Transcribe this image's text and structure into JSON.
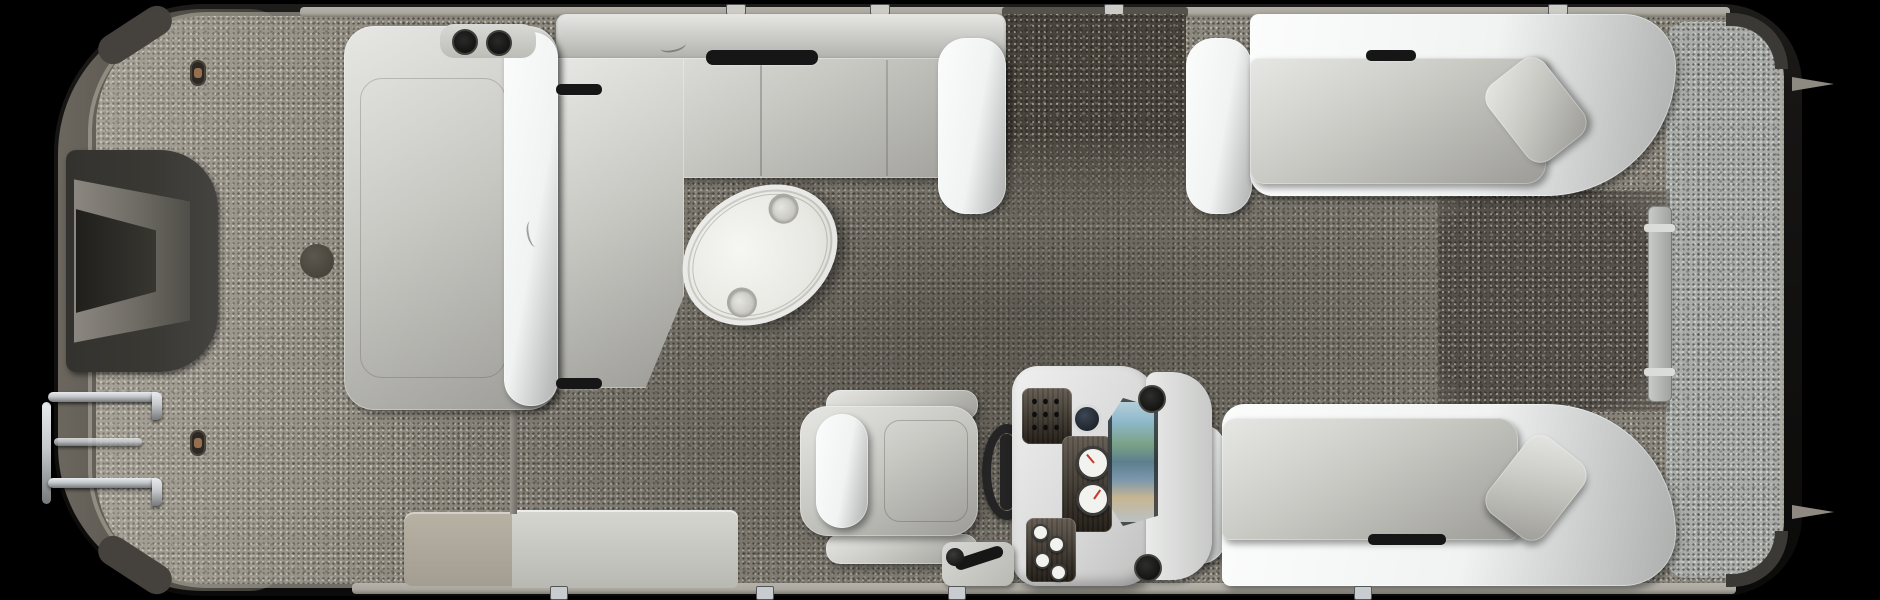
{
  "image": {
    "alt": "Overhead 3D render of a pontoon boat floor plan: bow boarding platform with ladder at left, long port chaise lounger, wraparound benches with an oval cocktail table, captain's chair with helm console and gauges, twin curved stern lounges with rear gate and swim deck at right"
  },
  "colors": {
    "background": "#000000",
    "hull_dark": "#161514",
    "bow_trim": "#6b675f",
    "notch_dark": "#3a3833",
    "rail_light": "#aaa79e",
    "carpet_main": "#8d897f",
    "carpet_dark": "#48443c",
    "carpet_rear": "#a9aca9",
    "upholstery": "#c9c9c4",
    "upholstery_bright": "#f1f3f3",
    "table_top": "#f6f6f2",
    "console_white": "#eff0ef",
    "dash_wood": "#473d30",
    "detail_black": "#161616",
    "gauge_face": "#f2f2ee",
    "needle_red": "#c23b2e",
    "windshield_sky": "#8fb9cc",
    "windshield_land": "#7ba287",
    "windshield_sand": "#c7b593",
    "metal_chrome": "#c6c9cc",
    "copper": "#966f4f"
  }
}
